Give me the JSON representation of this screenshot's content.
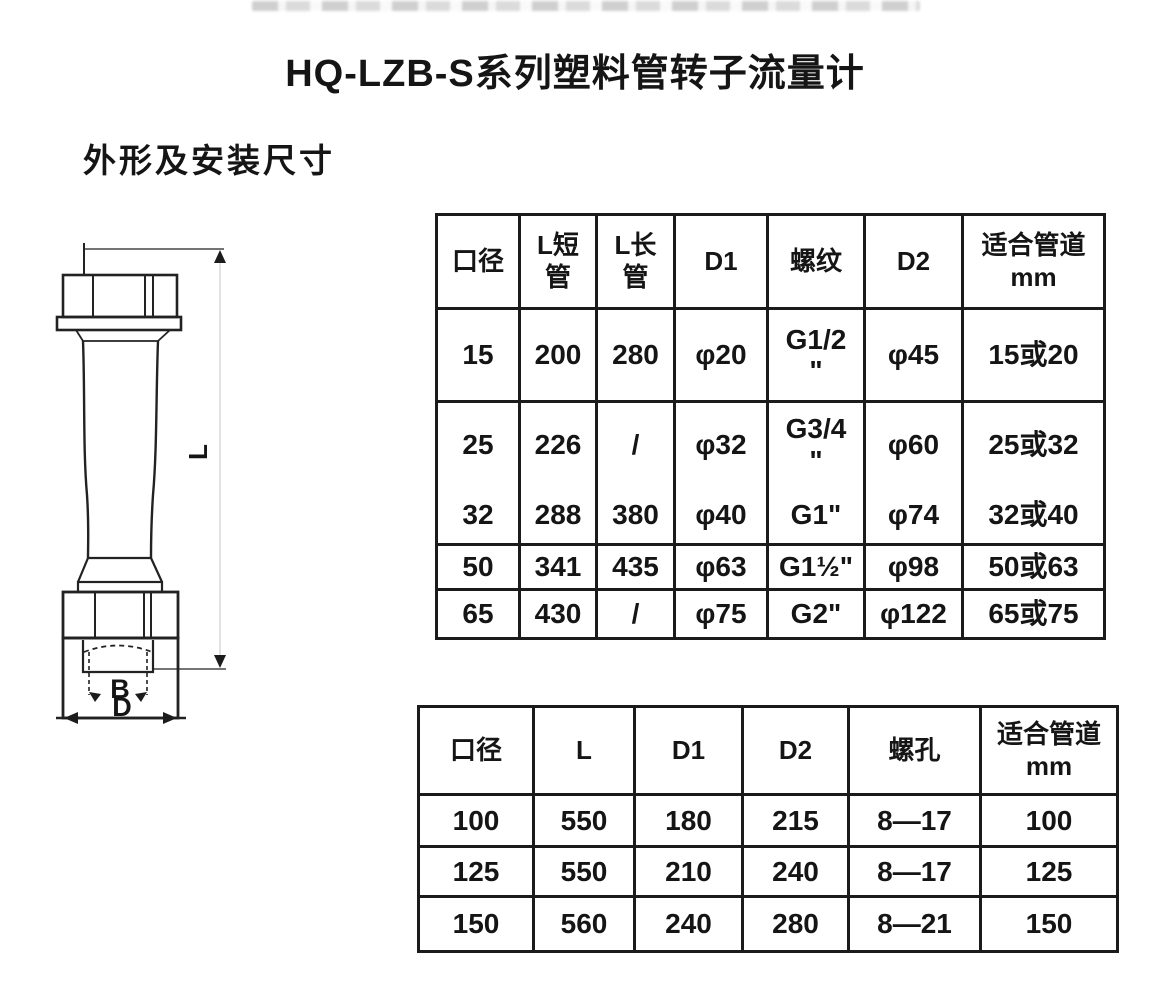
{
  "page": {
    "title": "HQ-LZB-S系列塑料管转子流量计",
    "section_heading": "外形及安装尺寸"
  },
  "diagram": {
    "label_l": "L",
    "label_b": "B",
    "label_d": "D"
  },
  "table1": {
    "headers": [
      "口径",
      "L短\n管",
      "L长\n管",
      "D1",
      "螺纹",
      "D2",
      "适合管道\nmm"
    ],
    "rows": [
      [
        "15",
        "200",
        "280",
        "φ20",
        "G1/2\n\"",
        "φ45",
        "15或20"
      ],
      [
        "25",
        "226",
        "/",
        "φ32",
        "G3/4\n\"",
        "φ60",
        "25或32"
      ],
      [
        "32",
        "288",
        "380",
        "φ40",
        "G1\"",
        "φ74",
        "32或40"
      ],
      [
        "50",
        "341",
        "435",
        "φ63",
        "G1½\"",
        "φ98",
        "50或63"
      ],
      [
        "65",
        "430",
        "/",
        "φ75",
        "G2\"",
        "φ122",
        "65或75"
      ]
    ]
  },
  "table2": {
    "headers": [
      "口径",
      "L",
      "D1",
      "D2",
      "螺孔",
      "适合管道\nmm"
    ],
    "rows": [
      [
        "100",
        "550",
        "180",
        "215",
        "8—17",
        "100"
      ],
      [
        "125",
        "550",
        "210",
        "240",
        "8—17",
        "125"
      ],
      [
        "150",
        "560",
        "240",
        "280",
        "8—21",
        "150"
      ]
    ]
  }
}
